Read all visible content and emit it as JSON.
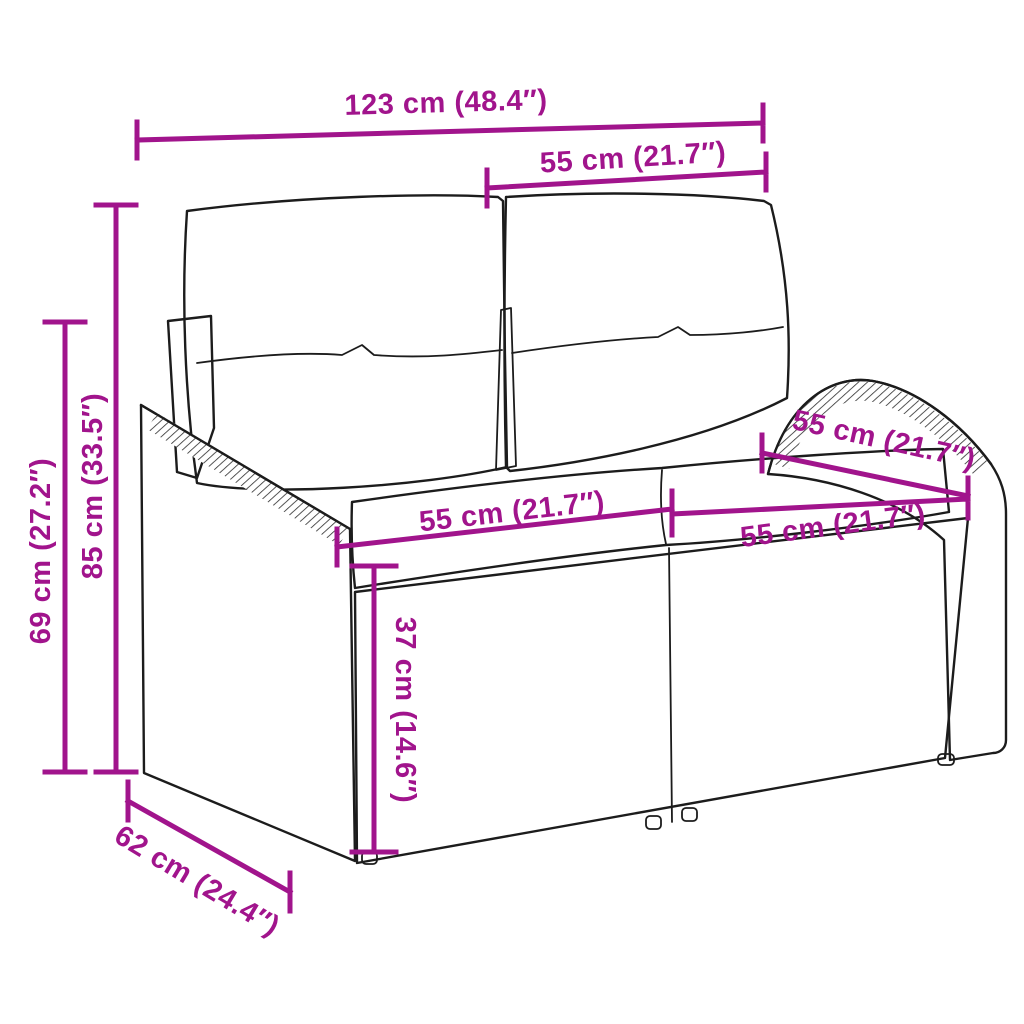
{
  "page": {
    "title": "Garden sofa dimension diagram",
    "background": "#ffffff"
  },
  "style": {
    "dimension_color": "#a1148c",
    "drawing_color": "#1c1c1c"
  },
  "product": {
    "name": "2-seater poly rattan garden sofa with back and seat cushions"
  },
  "dimensions": {
    "overall_width": {
      "label": "123 cm (48.4″)",
      "meaning": "overall width"
    },
    "backrest_width": {
      "label": "55 cm (21.7″)",
      "meaning": "back cushion width"
    },
    "total_height": {
      "label": "85 cm (33.5″)",
      "meaning": "total height"
    },
    "arm_height": {
      "label": "69 cm (27.2″)",
      "meaning": "armrest height"
    },
    "seat_width_left": {
      "label": "55 cm (21.7″)",
      "meaning": "left seat width"
    },
    "seat_width_right": {
      "label": "55 cm (21.7″)",
      "meaning": "right seat width"
    },
    "seat_depth": {
      "label": "55 cm (21.7″)",
      "meaning": "seat depth along armrest"
    },
    "seat_height": {
      "label": "37 cm (14.6″)",
      "meaning": "seat height from ground"
    },
    "overall_depth": {
      "label": "62 cm (24.4″)",
      "meaning": "overall depth"
    }
  }
}
